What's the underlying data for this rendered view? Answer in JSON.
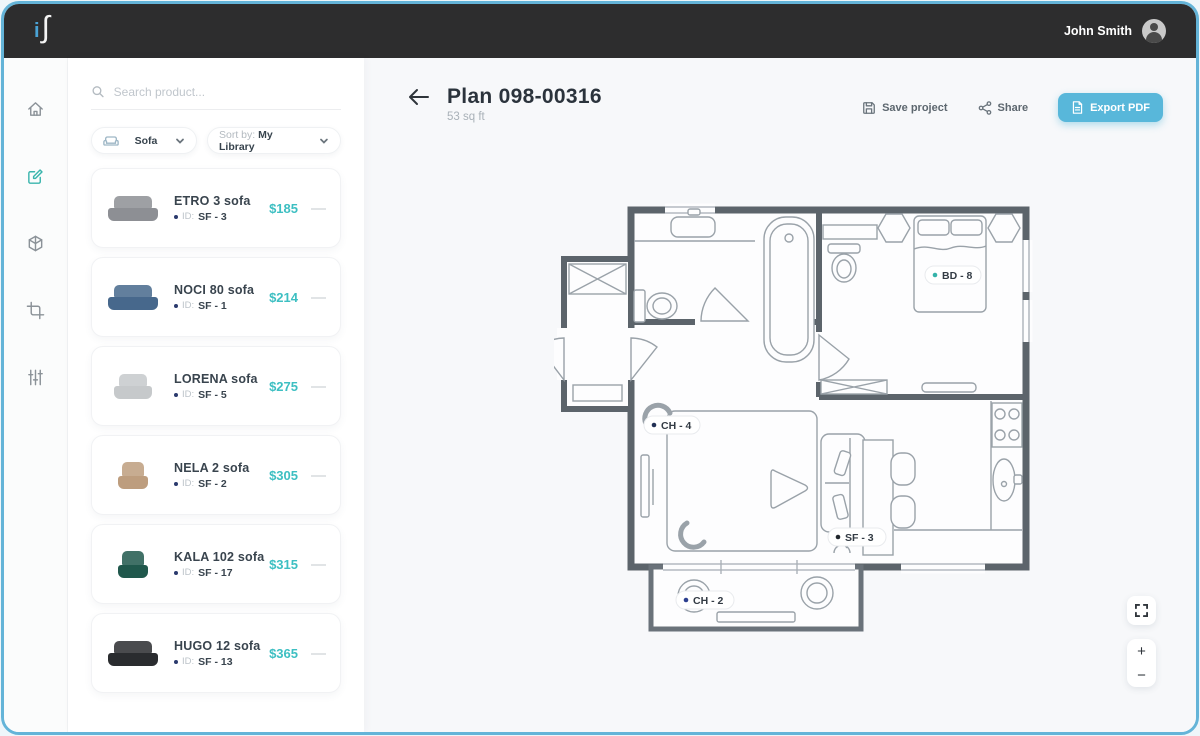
{
  "brand": {
    "logo_i": "i",
    "logo_s": "∫"
  },
  "topbar": {
    "user_name": "John Smith"
  },
  "rail": {
    "items": [
      {
        "icon": "home-icon",
        "active": false
      },
      {
        "icon": "edit-plan-icon",
        "active": true
      },
      {
        "icon": "3d-view-icon",
        "active": false
      },
      {
        "icon": "crop-icon",
        "active": false
      },
      {
        "icon": "filters-icon",
        "active": false
      }
    ]
  },
  "sidebar": {
    "search_placeholder": "Search product...",
    "filters": {
      "category": "Sofa",
      "sort_label": "Sort by:",
      "sort_value": "My Library"
    },
    "remove_symbol": "—",
    "products": [
      {
        "name": "ETRO 3 sofa",
        "id_label": "ID:",
        "id": "SF - 3",
        "price": "$185",
        "color": "#8d8f94"
      },
      {
        "name": "NOCI 80 sofa",
        "id_label": "ID:",
        "id": "SF - 1",
        "price": "$214",
        "color": "#47688c"
      },
      {
        "name": "LORENA sofa",
        "id_label": "ID:",
        "id": "SF - 5",
        "price": "$275",
        "color": "#c6c9cb"
      },
      {
        "name": "NELA 2 sofa",
        "id_label": "ID:",
        "id": "SF - 2",
        "price": "$305",
        "color": "#bd9d7e"
      },
      {
        "name": "KALA 102 sofa",
        "id_label": "ID:",
        "id": "SF - 17",
        "price": "$315",
        "color": "#20584c"
      },
      {
        "name": "HUGO 12 sofa",
        "id_label": "ID:",
        "id": "SF - 13",
        "price": "$365",
        "color": "#2a2c2f"
      }
    ]
  },
  "header": {
    "title": "Plan 098-00316",
    "subtitle": "53 sq ft",
    "save_label": "Save project",
    "share_label": "Share",
    "export_label": "Export PDF"
  },
  "plan": {
    "labels": [
      {
        "text": "BD - 8",
        "dot": "#35b3aa"
      },
      {
        "text": "CH - 4",
        "dot": "#223055"
      },
      {
        "text": "SF - 3",
        "dot": "#20262c"
      },
      {
        "text": "CH - 2",
        "dot": "#2c3f8f"
      }
    ]
  },
  "controls": {
    "zoom_in": "+",
    "zoom_out": "−"
  },
  "colors": {
    "accent": "#3dbfc2",
    "export_button": "#58b7da",
    "wall": "#5c646b",
    "frame_border": "#64b4d8"
  }
}
